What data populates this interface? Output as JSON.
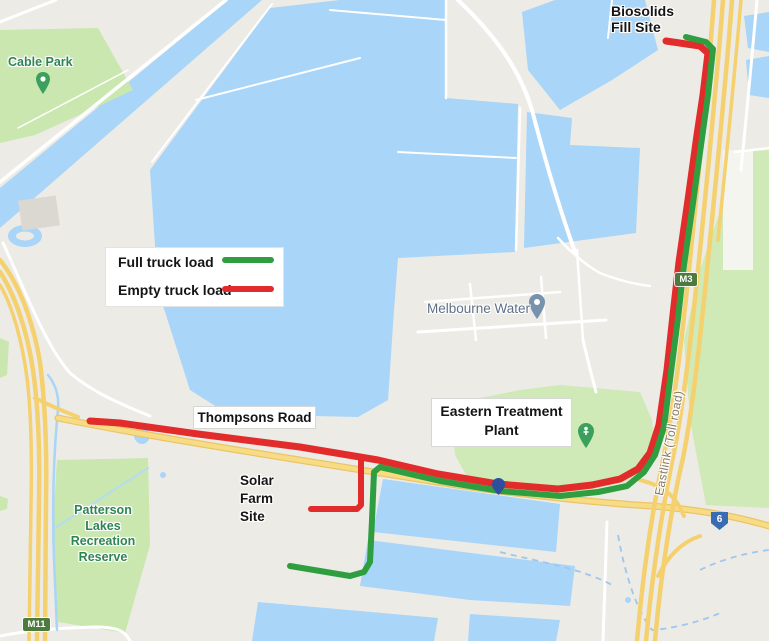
{
  "map": {
    "labels": {
      "biosolids_site": "Biosolids\nFill Site",
      "cable_park": "Cable Park",
      "melbourne_water": "Melbourne Water",
      "eastern_treatment_plant": "Eastern Treatment\nPlant",
      "thompsons_road": "Thompsons Road",
      "solar_farm_site": "Solar\nFarm\nSite",
      "patterson_lakes": "Patterson\nLakes\nRecreation\nReserve",
      "eastlink": "Eastlink (Toll road)"
    },
    "badges": {
      "m3": "M3",
      "m11": "M11",
      "route6": "6"
    },
    "colors": {
      "route_full": "#2f9e41",
      "route_empty": "#e22b2b",
      "water": "#a8d5f8",
      "park": "#c9e7af",
      "freeway_yellow": "#f5d06e",
      "badge_green": "#4d7a3d",
      "shield_blue": "#3a6cb4",
      "background": "#edebe6"
    }
  },
  "legend": {
    "items": [
      {
        "label": "Full truck load",
        "color": "#2f9e41"
      },
      {
        "label": "Empty truck load",
        "color": "#e22b2b"
      }
    ]
  }
}
